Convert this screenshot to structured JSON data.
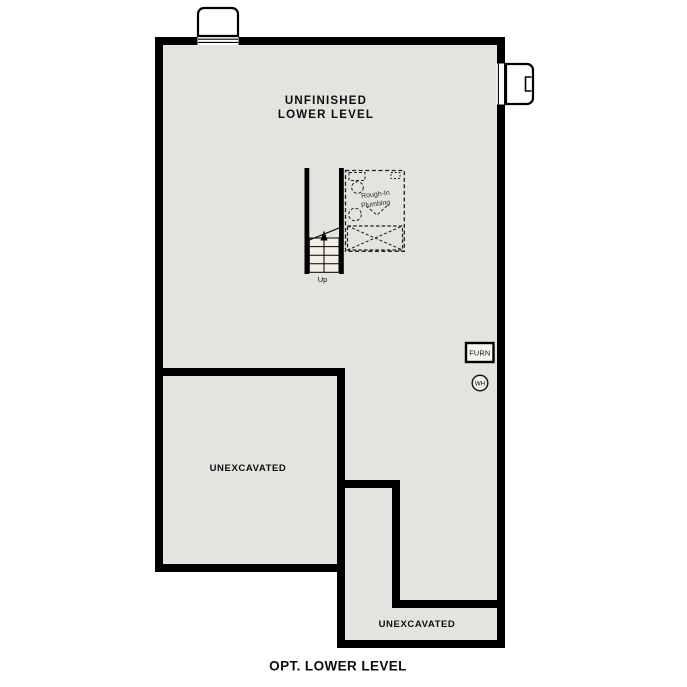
{
  "plan": {
    "title": "OPT. LOWER LEVEL",
    "main_room": {
      "label_line1": "UNFINISHED",
      "label_line2": "LOWER LEVEL"
    },
    "unexcavated_left": {
      "label": "UNEXCAVATED"
    },
    "unexcavated_bottom": {
      "label": "UNEXCAVATED"
    },
    "stairs": {
      "direction_label": "Up"
    },
    "rough_in_plumbing": {
      "label_line1": "Rough-In",
      "label_line2": "Plumbing"
    },
    "furnace": {
      "label": "FURN"
    },
    "water_heater": {
      "label": "WH"
    },
    "colors": {
      "wall": "#000000",
      "floor": "#e4e3e0",
      "stair_tread": "#f3efe6",
      "background": "#ffffff",
      "dashed_line": "#1f1f1f"
    }
  }
}
